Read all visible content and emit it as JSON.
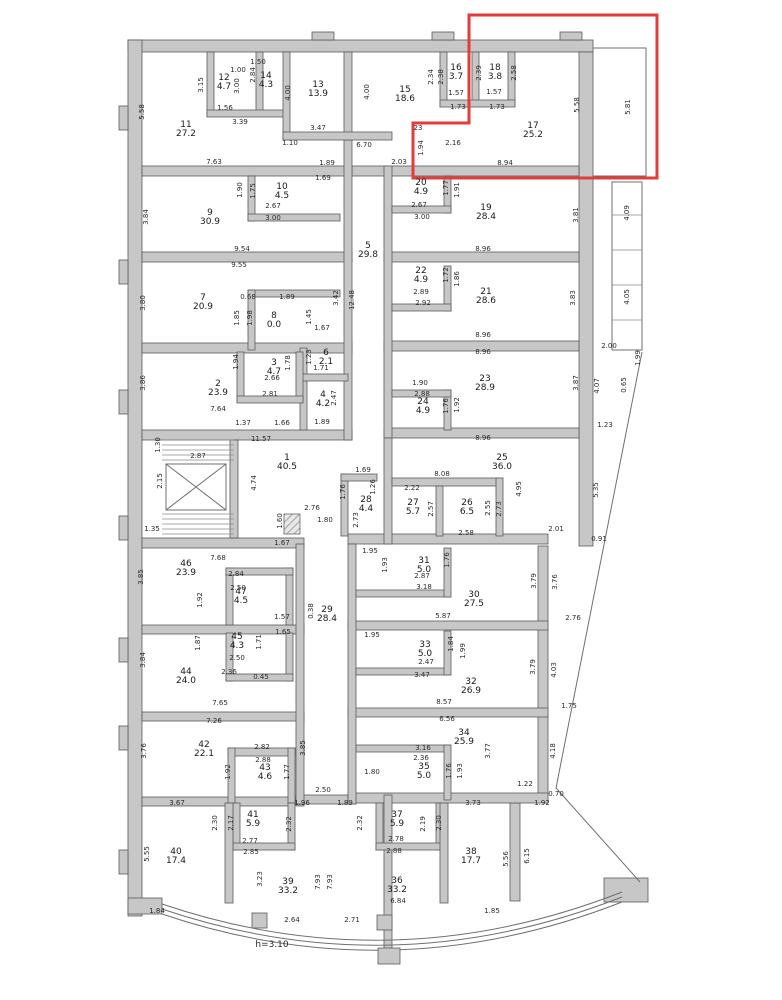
{
  "title": "Floor plan",
  "highlight": {
    "color": "#e13d3b",
    "region": "top-right"
  },
  "floorplan": {
    "ceiling_height_note": "h=3.10",
    "rooms": [
      {
        "n": "1",
        "a": "40.5",
        "x": 287,
        "y": 463
      },
      {
        "n": "2",
        "a": "23.9",
        "x": 218,
        "y": 389
      },
      {
        "n": "3",
        "a": "4.7",
        "x": 274,
        "y": 368
      },
      {
        "n": "4",
        "a": "4.2",
        "x": 323,
        "y": 400
      },
      {
        "n": "5",
        "a": "29.8",
        "x": 368,
        "y": 251
      },
      {
        "n": "6",
        "a": "2.1",
        "x": 326,
        "y": 358
      },
      {
        "n": "7",
        "a": "20.9",
        "x": 203,
        "y": 303
      },
      {
        "n": "8",
        "a": "0.0",
        "x": 274,
        "y": 321
      },
      {
        "n": "9",
        "a": "30.9",
        "x": 210,
        "y": 218
      },
      {
        "n": "10",
        "a": "4.5",
        "x": 282,
        "y": 192
      },
      {
        "n": "11",
        "a": "27.2",
        "x": 186,
        "y": 130
      },
      {
        "n": "12",
        "a": "4.7",
        "x": 224,
        "y": 83
      },
      {
        "n": "13",
        "a": "13.9",
        "x": 318,
        "y": 90
      },
      {
        "n": "14",
        "a": "4.3",
        "x": 266,
        "y": 81
      },
      {
        "n": "15",
        "a": "18.6",
        "x": 405,
        "y": 95
      },
      {
        "n": "16",
        "a": "3.7",
        "x": 456,
        "y": 73
      },
      {
        "n": "17",
        "a": "25.2",
        "x": 533,
        "y": 131
      },
      {
        "n": "18",
        "a": "3.8",
        "x": 495,
        "y": 73
      },
      {
        "n": "19",
        "a": "28.4",
        "x": 486,
        "y": 213
      },
      {
        "n": "20",
        "a": "4.9",
        "x": 421,
        "y": 188
      },
      {
        "n": "21",
        "a": "28.6",
        "x": 486,
        "y": 297
      },
      {
        "n": "22",
        "a": "4.9",
        "x": 421,
        "y": 276
      },
      {
        "n": "23",
        "a": "28.9",
        "x": 485,
        "y": 384
      },
      {
        "n": "24",
        "a": "4.9",
        "x": 423,
        "y": 407
      },
      {
        "n": "25",
        "a": "36.0",
        "x": 502,
        "y": 463
      },
      {
        "n": "26",
        "a": "6.5",
        "x": 467,
        "y": 508
      },
      {
        "n": "27",
        "a": "5.7",
        "x": 413,
        "y": 508
      },
      {
        "n": "28",
        "a": "4.4",
        "x": 366,
        "y": 505
      },
      {
        "n": "29",
        "a": "28.4",
        "x": 327,
        "y": 615
      },
      {
        "n": "30",
        "a": "27.5",
        "x": 474,
        "y": 600
      },
      {
        "n": "31",
        "a": "5.0",
        "x": 424,
        "y": 566
      },
      {
        "n": "32",
        "a": "26.9",
        "x": 471,
        "y": 687
      },
      {
        "n": "33",
        "a": "5.0",
        "x": 425,
        "y": 650
      },
      {
        "n": "34",
        "a": "25.9",
        "x": 464,
        "y": 738
      },
      {
        "n": "35",
        "a": "5.0",
        "x": 424,
        "y": 772
      },
      {
        "n": "36",
        "a": "33.2",
        "x": 397,
        "y": 886
      },
      {
        "n": "37",
        "a": "5.9",
        "x": 397,
        "y": 820
      },
      {
        "n": "38",
        "a": "17.7",
        "x": 471,
        "y": 857
      },
      {
        "n": "39",
        "a": "33.2",
        "x": 288,
        "y": 887
      },
      {
        "n": "40",
        "a": "17.4",
        "x": 176,
        "y": 857
      },
      {
        "n": "41",
        "a": "5.9",
        "x": 253,
        "y": 820
      },
      {
        "n": "42",
        "a": "22.1",
        "x": 204,
        "y": 750
      },
      {
        "n": "43",
        "a": "4.6",
        "x": 265,
        "y": 773
      },
      {
        "n": "44",
        "a": "24.0",
        "x": 186,
        "y": 677
      },
      {
        "n": "45",
        "a": "4.3",
        "x": 237,
        "y": 642
      },
      {
        "n": "46",
        "a": "23.9",
        "x": 186,
        "y": 569
      },
      {
        "n": "47",
        "a": "4.5",
        "x": 241,
        "y": 597
      }
    ],
    "dimensions": [
      {
        "t": "5.58",
        "x": 142,
        "y": 112,
        "v": 1
      },
      {
        "t": "3.15",
        "x": 201,
        "y": 85,
        "v": 1
      },
      {
        "t": "1.00",
        "x": 238,
        "y": 70
      },
      {
        "t": "2.84",
        "x": 253,
        "y": 75,
        "v": 1
      },
      {
        "t": "1.50",
        "x": 258,
        "y": 62
      },
      {
        "t": "3.00",
        "x": 237,
        "y": 86,
        "v": 1
      },
      {
        "t": "4.00",
        "x": 288,
        "y": 93,
        "v": 1
      },
      {
        "t": "4.00",
        "x": 367,
        "y": 92,
        "v": 1
      },
      {
        "t": "1.56",
        "x": 225,
        "y": 108
      },
      {
        "t": "3.39",
        "x": 240,
        "y": 122
      },
      {
        "t": "3.47",
        "x": 318,
        "y": 128
      },
      {
        "t": "1.10",
        "x": 290,
        "y": 143
      },
      {
        "t": "6.70",
        "x": 364,
        "y": 145
      },
      {
        "t": "7.63",
        "x": 214,
        "y": 162
      },
      {
        "t": "1.89",
        "x": 327,
        "y": 163
      },
      {
        "t": "1.69",
        "x": 323,
        "y": 178
      },
      {
        "t": "2.34",
        "x": 431,
        "y": 77,
        "v": 1
      },
      {
        "t": "2.38",
        "x": 441,
        "y": 77,
        "v": 1
      },
      {
        "t": "2.39",
        "x": 479,
        "y": 73,
        "v": 1
      },
      {
        "t": "2.58",
        "x": 514,
        "y": 73,
        "v": 1
      },
      {
        "t": "1.57",
        "x": 456,
        "y": 93
      },
      {
        "t": "1.73",
        "x": 458,
        "y": 107
      },
      {
        "t": "1.57",
        "x": 494,
        "y": 92
      },
      {
        "t": "1.73",
        "x": 497,
        "y": 107
      },
      {
        "t": "5.58",
        "x": 577,
        "y": 105,
        "v": 1
      },
      {
        "t": "5.81",
        "x": 628,
        "y": 107,
        "v": 1
      },
      {
        "t": "23",
        "x": 418,
        "y": 128
      },
      {
        "t": "1.94",
        "x": 421,
        "y": 148,
        "v": 1
      },
      {
        "t": "2.16",
        "x": 453,
        "y": 143
      },
      {
        "t": "2.03",
        "x": 399,
        "y": 162
      },
      {
        "t": "8.94",
        "x": 505,
        "y": 163
      },
      {
        "t": "1.90",
        "x": 240,
        "y": 190,
        "v": 1
      },
      {
        "t": "1.75",
        "x": 253,
        "y": 191,
        "v": 1
      },
      {
        "t": "2.67",
        "x": 273,
        "y": 206
      },
      {
        "t": "3.00",
        "x": 273,
        "y": 218
      },
      {
        "t": "3.84",
        "x": 146,
        "y": 217,
        "v": 1
      },
      {
        "t": "9.54",
        "x": 242,
        "y": 249
      },
      {
        "t": "9.55",
        "x": 239,
        "y": 265
      },
      {
        "t": "1.77",
        "x": 446,
        "y": 188,
        "v": 1
      },
      {
        "t": "1.91",
        "x": 457,
        "y": 190,
        "v": 1
      },
      {
        "t": "2.67",
        "x": 419,
        "y": 205
      },
      {
        "t": "3.00",
        "x": 422,
        "y": 217
      },
      {
        "t": "8.96",
        "x": 483,
        "y": 249
      },
      {
        "t": "3.81",
        "x": 576,
        "y": 215,
        "v": 1
      },
      {
        "t": "4.09",
        "x": 627,
        "y": 213,
        "v": 1
      },
      {
        "t": "12.48",
        "x": 352,
        "y": 300,
        "v": 1
      },
      {
        "t": "3.42",
        "x": 336,
        "y": 298,
        "v": 1
      },
      {
        "t": "3.80",
        "x": 143,
        "y": 303,
        "v": 1
      },
      {
        "t": "0.68",
        "x": 248,
        "y": 297
      },
      {
        "t": "1.89",
        "x": 287,
        "y": 297
      },
      {
        "t": "1.85",
        "x": 237,
        "y": 318,
        "v": 1
      },
      {
        "t": "1.98",
        "x": 250,
        "y": 318,
        "v": 1
      },
      {
        "t": "1.45",
        "x": 309,
        "y": 317,
        "v": 1
      },
      {
        "t": "1.67",
        "x": 322,
        "y": 328
      },
      {
        "t": "1.72",
        "x": 446,
        "y": 275,
        "v": 1
      },
      {
        "t": "1.86",
        "x": 457,
        "y": 279,
        "v": 1
      },
      {
        "t": "2.89",
        "x": 421,
        "y": 292
      },
      {
        "t": "2.92",
        "x": 423,
        "y": 303
      },
      {
        "t": "8.96",
        "x": 483,
        "y": 335
      },
      {
        "t": "3.83",
        "x": 573,
        "y": 298,
        "v": 1
      },
      {
        "t": "4.05",
        "x": 627,
        "y": 297,
        "v": 1
      },
      {
        "t": "2.00",
        "x": 609,
        "y": 346
      },
      {
        "t": "1.99",
        "x": 638,
        "y": 358,
        "v": 1
      },
      {
        "t": "8.96",
        "x": 483,
        "y": 352
      },
      {
        "t": "3.86",
        "x": 143,
        "y": 383,
        "v": 1
      },
      {
        "t": "1.94",
        "x": 236,
        "y": 362,
        "v": 1
      },
      {
        "t": "1.78",
        "x": 288,
        "y": 363,
        "v": 1
      },
      {
        "t": "1.23",
        "x": 309,
        "y": 357,
        "v": 1
      },
      {
        "t": "1.71",
        "x": 321,
        "y": 368
      },
      {
        "t": "2.47",
        "x": 334,
        "y": 398,
        "v": 1
      },
      {
        "t": "2.66",
        "x": 272,
        "y": 378
      },
      {
        "t": "2.81",
        "x": 270,
        "y": 394
      },
      {
        "t": "7.64",
        "x": 218,
        "y": 409
      },
      {
        "t": "1.37",
        "x": 243,
        "y": 423
      },
      {
        "t": "1.66",
        "x": 282,
        "y": 423
      },
      {
        "t": "1.89",
        "x": 322,
        "y": 422
      },
      {
        "t": "1.90",
        "x": 420,
        "y": 383
      },
      {
        "t": "2.88",
        "x": 422,
        "y": 394
      },
      {
        "t": "1.76",
        "x": 446,
        "y": 406,
        "v": 1
      },
      {
        "t": "1.92",
        "x": 457,
        "y": 405,
        "v": 1
      },
      {
        "t": "8.96",
        "x": 483,
        "y": 438
      },
      {
        "t": "3.87",
        "x": 576,
        "y": 383,
        "v": 1
      },
      {
        "t": "4.07",
        "x": 597,
        "y": 386,
        "v": 1
      },
      {
        "t": "1.23",
        "x": 605,
        "y": 425
      },
      {
        "t": "0.65",
        "x": 624,
        "y": 385,
        "v": 1
      },
      {
        "t": "1.30",
        "x": 158,
        "y": 445,
        "v": 1
      },
      {
        "t": "2.87",
        "x": 198,
        "y": 456
      },
      {
        "t": "2.15",
        "x": 160,
        "y": 481,
        "v": 1
      },
      {
        "t": "1.35",
        "x": 152,
        "y": 529
      },
      {
        "t": "11.57",
        "x": 261,
        "y": 439
      },
      {
        "t": "4.74",
        "x": 254,
        "y": 483,
        "v": 1
      },
      {
        "t": "2.76",
        "x": 312,
        "y": 508
      },
      {
        "t": "1.60",
        "x": 280,
        "y": 521,
        "v": 1
      },
      {
        "t": "1.80",
        "x": 325,
        "y": 520
      },
      {
        "t": "1.69",
        "x": 363,
        "y": 470
      },
      {
        "t": "1.26",
        "x": 373,
        "y": 487,
        "v": 1
      },
      {
        "t": "1.76",
        "x": 343,
        "y": 492,
        "v": 1
      },
      {
        "t": "2.73",
        "x": 356,
        "y": 520,
        "v": 1
      },
      {
        "t": "8.08",
        "x": 442,
        "y": 474
      },
      {
        "t": "2.22",
        "x": 412,
        "y": 488
      },
      {
        "t": "2.57",
        "x": 431,
        "y": 509,
        "v": 1
      },
      {
        "t": "2.55",
        "x": 488,
        "y": 508,
        "v": 1
      },
      {
        "t": "2.73",
        "x": 499,
        "y": 509,
        "v": 1
      },
      {
        "t": "2.58",
        "x": 466,
        "y": 533
      },
      {
        "t": "4.95",
        "x": 519,
        "y": 489,
        "v": 1
      },
      {
        "t": "5.35",
        "x": 596,
        "y": 490,
        "v": 1
      },
      {
        "t": "2.01",
        "x": 556,
        "y": 529
      },
      {
        "t": "0.91",
        "x": 599,
        "y": 539
      },
      {
        "t": "1.67",
        "x": 282,
        "y": 543
      },
      {
        "t": "7.68",
        "x": 218,
        "y": 558
      },
      {
        "t": "3.85",
        "x": 141,
        "y": 577,
        "v": 1
      },
      {
        "t": "1.92",
        "x": 200,
        "y": 600,
        "v": 1
      },
      {
        "t": "2.84",
        "x": 236,
        "y": 574
      },
      {
        "t": "2.50",
        "x": 238,
        "y": 588
      },
      {
        "t": "1.57",
        "x": 282,
        "y": 617
      },
      {
        "t": "0.38",
        "x": 311,
        "y": 611,
        "v": 1
      },
      {
        "t": "1.95",
        "x": 370,
        "y": 551
      },
      {
        "t": "1.93",
        "x": 385,
        "y": 565,
        "v": 1
      },
      {
        "t": "1.76",
        "x": 447,
        "y": 560,
        "v": 1
      },
      {
        "t": "2.87",
        "x": 422,
        "y": 576
      },
      {
        "t": "3.18",
        "x": 424,
        "y": 587
      },
      {
        "t": "5.87",
        "x": 443,
        "y": 616
      },
      {
        "t": "3.79",
        "x": 534,
        "y": 581,
        "v": 1
      },
      {
        "t": "3.76",
        "x": 555,
        "y": 582,
        "v": 1
      },
      {
        "t": "2.76",
        "x": 573,
        "y": 618
      },
      {
        "t": "1.65",
        "x": 283,
        "y": 632
      },
      {
        "t": "1.87",
        "x": 198,
        "y": 643,
        "v": 1
      },
      {
        "t": "1.71",
        "x": 259,
        "y": 642,
        "v": 1
      },
      {
        "t": "2.50",
        "x": 237,
        "y": 658
      },
      {
        "t": "2.36",
        "x": 229,
        "y": 672
      },
      {
        "t": "0.45",
        "x": 261,
        "y": 677
      },
      {
        "t": "3.84",
        "x": 143,
        "y": 660,
        "v": 1
      },
      {
        "t": "7.65",
        "x": 220,
        "y": 703
      },
      {
        "t": "7.26",
        "x": 214,
        "y": 721
      },
      {
        "t": "1.95",
        "x": 372,
        "y": 635
      },
      {
        "t": "1.84",
        "x": 451,
        "y": 644,
        "v": 1
      },
      {
        "t": "1.99",
        "x": 463,
        "y": 651,
        "v": 1
      },
      {
        "t": "2.47",
        "x": 426,
        "y": 662
      },
      {
        "t": "3.47",
        "x": 422,
        "y": 675
      },
      {
        "t": "8.57",
        "x": 444,
        "y": 702
      },
      {
        "t": "3.79",
        "x": 533,
        "y": 667,
        "v": 1
      },
      {
        "t": "4.03",
        "x": 554,
        "y": 670,
        "v": 1
      },
      {
        "t": "1.75",
        "x": 569,
        "y": 706
      },
      {
        "t": "6.56",
        "x": 447,
        "y": 719
      },
      {
        "t": "3.76",
        "x": 144,
        "y": 751,
        "v": 1
      },
      {
        "t": "2.82",
        "x": 262,
        "y": 747
      },
      {
        "t": "2.88",
        "x": 263,
        "y": 760
      },
      {
        "t": "1.92",
        "x": 228,
        "y": 772,
        "v": 1
      },
      {
        "t": "1.77",
        "x": 287,
        "y": 772,
        "v": 1
      },
      {
        "t": "3.85",
        "x": 303,
        "y": 748,
        "v": 1
      },
      {
        "t": "2.50",
        "x": 323,
        "y": 790
      },
      {
        "t": "3.16",
        "x": 423,
        "y": 748
      },
      {
        "t": "2.36",
        "x": 421,
        "y": 758
      },
      {
        "t": "1.76",
        "x": 449,
        "y": 771,
        "v": 1
      },
      {
        "t": "1.93",
        "x": 460,
        "y": 771,
        "v": 1
      },
      {
        "t": "3.77",
        "x": 488,
        "y": 751,
        "v": 1
      },
      {
        "t": "1.80",
        "x": 372,
        "y": 772
      },
      {
        "t": "1.22",
        "x": 525,
        "y": 784
      },
      {
        "t": "4.18",
        "x": 553,
        "y": 751,
        "v": 1
      },
      {
        "t": "0.70",
        "x": 556,
        "y": 794
      },
      {
        "t": "3.67",
        "x": 177,
        "y": 803
      },
      {
        "t": "1.96",
        "x": 302,
        "y": 803
      },
      {
        "t": "1.89",
        "x": 345,
        "y": 803
      },
      {
        "t": "3.73",
        "x": 473,
        "y": 803
      },
      {
        "t": "1.92",
        "x": 542,
        "y": 803
      },
      {
        "t": "2.30",
        "x": 215,
        "y": 823,
        "v": 1
      },
      {
        "t": "2.17",
        "x": 231,
        "y": 823,
        "v": 1
      },
      {
        "t": "2.32",
        "x": 289,
        "y": 824,
        "v": 1
      },
      {
        "t": "2.77",
        "x": 250,
        "y": 841
      },
      {
        "t": "2.85",
        "x": 251,
        "y": 852
      },
      {
        "t": "2.32",
        "x": 360,
        "y": 823,
        "v": 1
      },
      {
        "t": "2.19",
        "x": 423,
        "y": 824,
        "v": 1
      },
      {
        "t": "2.30",
        "x": 439,
        "y": 823,
        "v": 1
      },
      {
        "t": "2.78",
        "x": 396,
        "y": 839
      },
      {
        "t": "2.88",
        "x": 394,
        "y": 851
      },
      {
        "t": "5.55",
        "x": 147,
        "y": 854,
        "v": 1
      },
      {
        "t": "5.56",
        "x": 506,
        "y": 859,
        "v": 1
      },
      {
        "t": "6.15",
        "x": 527,
        "y": 856,
        "v": 1
      },
      {
        "t": "3.23",
        "x": 260,
        "y": 879,
        "v": 1
      },
      {
        "t": "7.93",
        "x": 318,
        "y": 882,
        "v": 1
      },
      {
        "t": "7.93",
        "x": 330,
        "y": 882,
        "v": 1
      },
      {
        "t": "6.84",
        "x": 398,
        "y": 901
      },
      {
        "t": "2.64",
        "x": 292,
        "y": 920
      },
      {
        "t": "2.71",
        "x": 352,
        "y": 920
      },
      {
        "t": "1.84",
        "x": 157,
        "y": 911
      },
      {
        "t": "1.85",
        "x": 492,
        "y": 911
      },
      {
        "t": "h=3.10",
        "x": 272,
        "y": 945,
        "big": 1
      }
    ]
  }
}
